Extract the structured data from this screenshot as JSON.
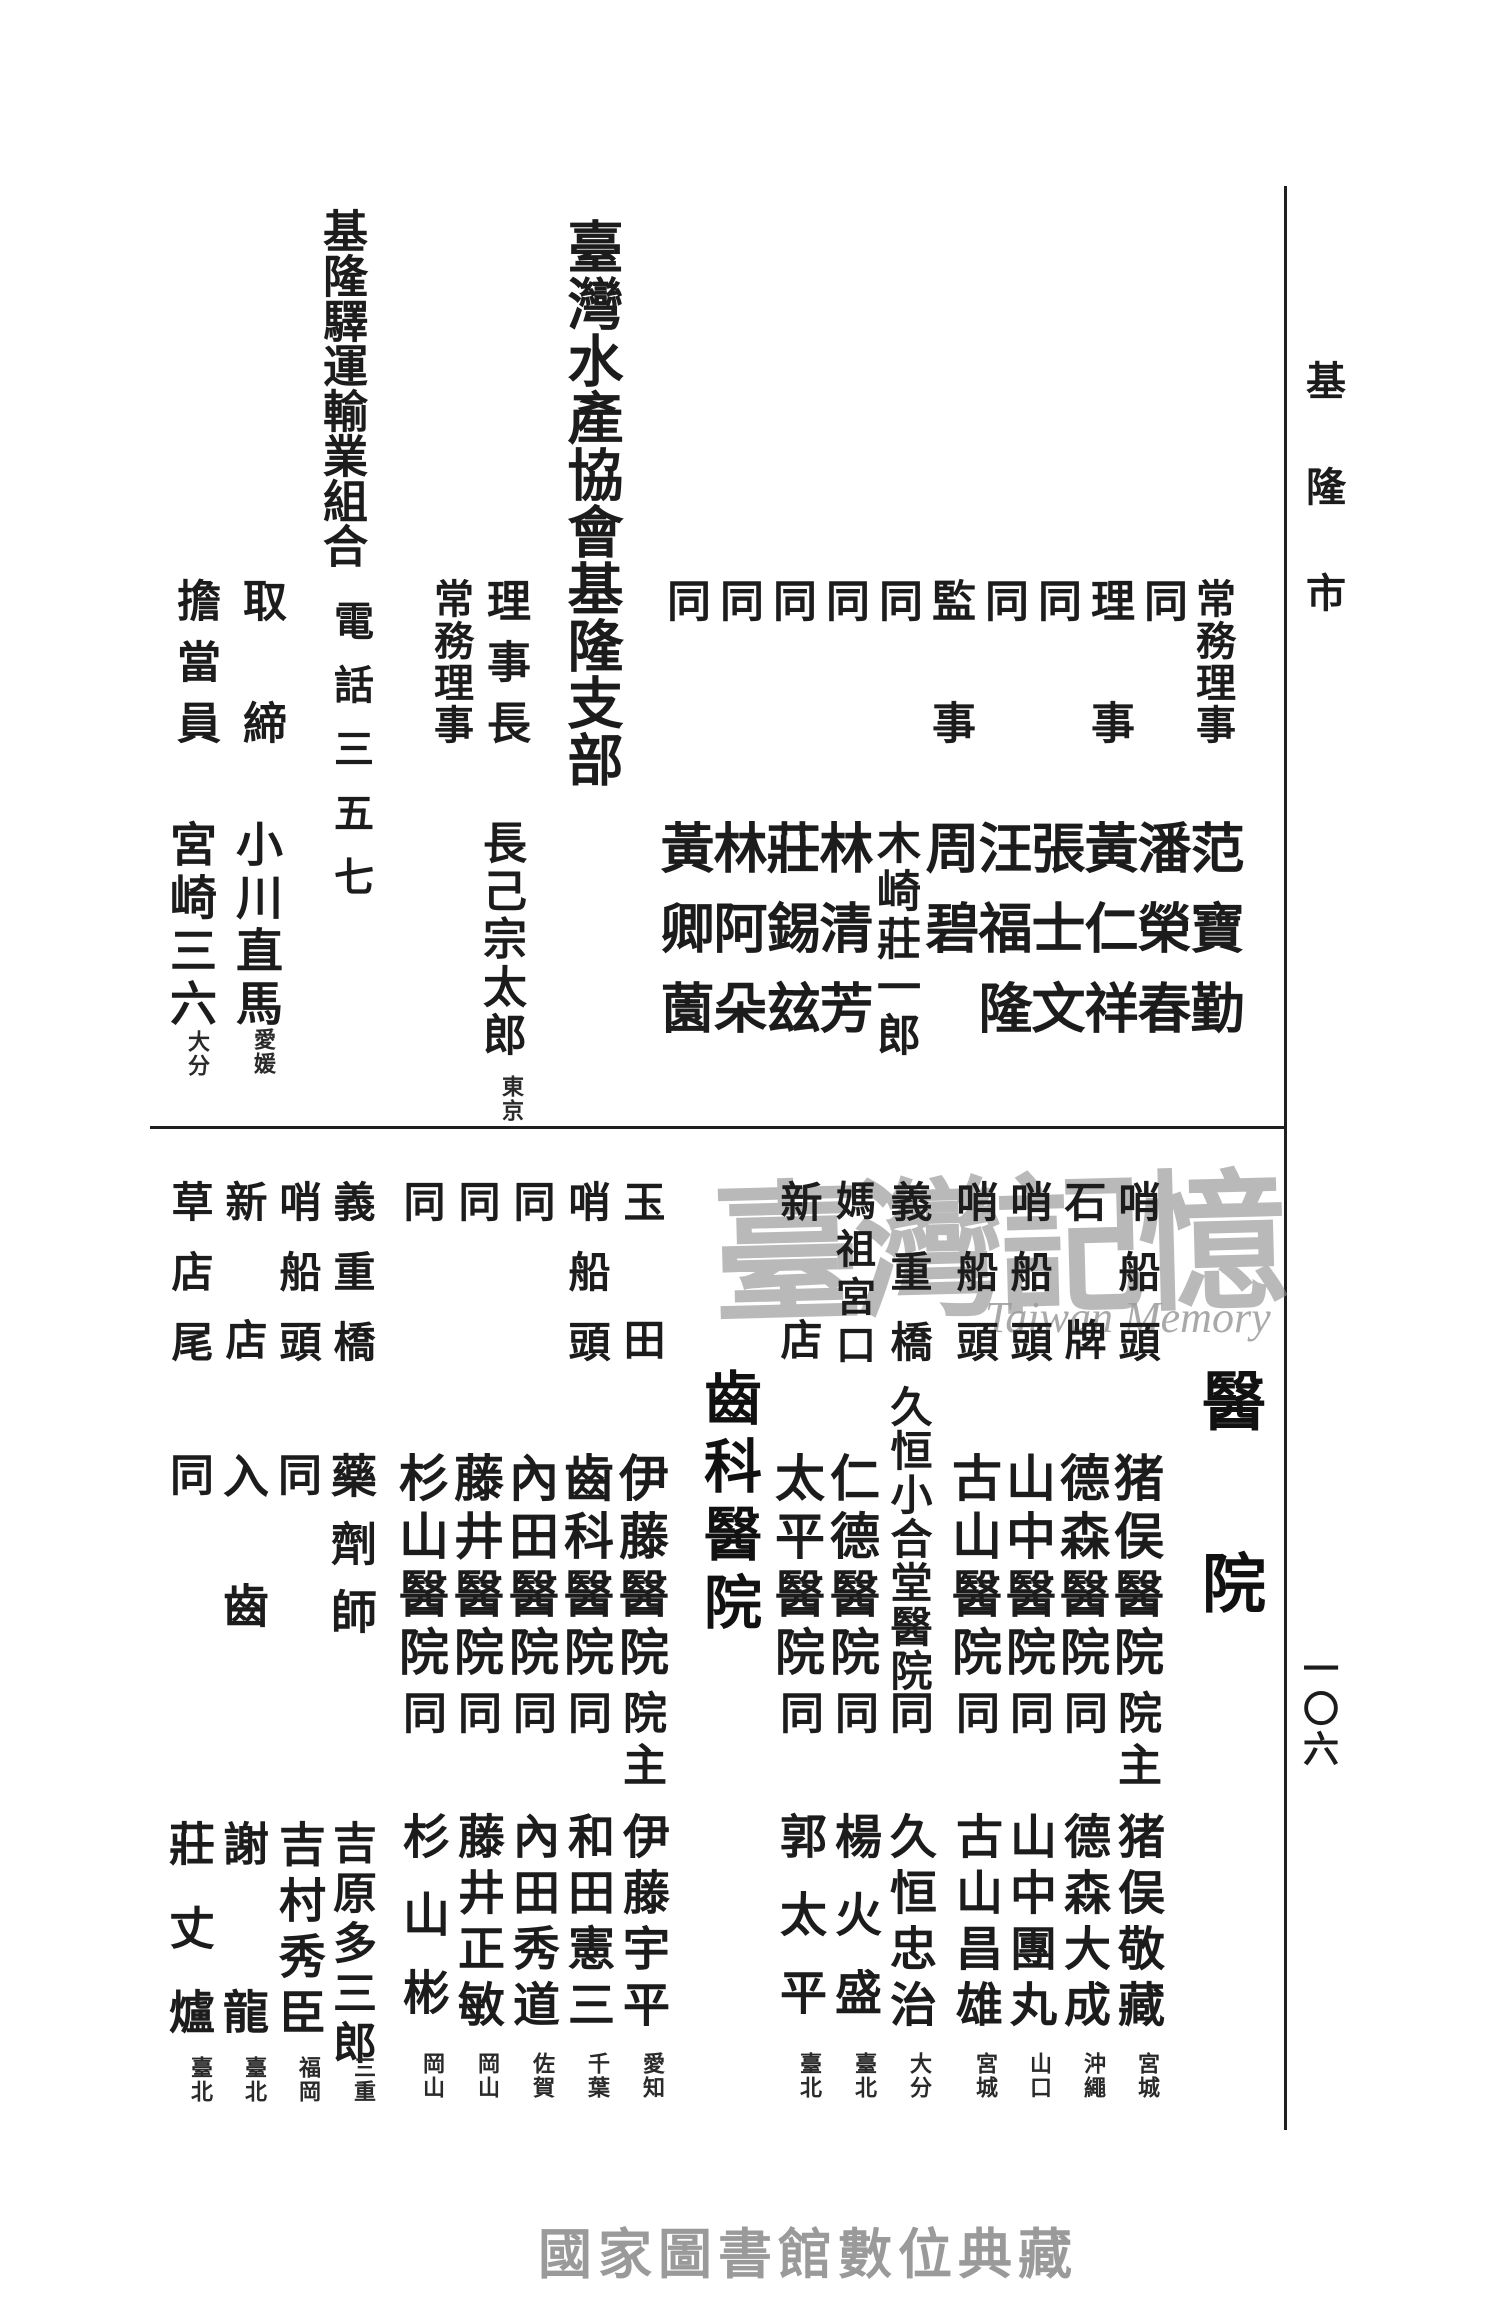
{
  "page": {
    "margin_label": "基隆市",
    "page_number": "一〇六",
    "footer": "國家圖書館數位典藏"
  },
  "watermark": {
    "text": "臺灣記憶",
    "subtext": "Taiwan Memory"
  },
  "top": {
    "officials": [
      {
        "role": "常務理事",
        "name": "范寶勤"
      },
      {
        "role": "同",
        "name": "潘榮春"
      },
      {
        "role": "理事",
        "name": "黃仁祥"
      },
      {
        "role": "同",
        "name": "張士文"
      },
      {
        "role": "同",
        "name": "汪福隆"
      },
      {
        "role": "監事",
        "name": "周碧"
      },
      {
        "role": "同",
        "name": "木崎莊一郎"
      },
      {
        "role": "同",
        "name": "林清芳"
      },
      {
        "role": "同",
        "name": "莊錫玆"
      },
      {
        "role": "同",
        "name": "林阿朵"
      },
      {
        "role": "同",
        "name": "黃卿薗"
      }
    ],
    "entry1": {
      "title": "臺灣水產協會基隆支部",
      "role1": "理事長",
      "name1": "長己宗太郎",
      "origin1": "東京",
      "role2": "常務理事"
    },
    "entry2": {
      "title": "基隆驛運輸業組合",
      "phone": "電話三五七",
      "role1": "取締",
      "name1": "小川直馬",
      "origin1": "愛媛",
      "role2": "擔當員",
      "name2": "宮崎三六",
      "origin2": "大分"
    }
  },
  "bottom": {
    "hospital_header": "醫院",
    "hospitals": [
      {
        "location": "哨船頭",
        "name": "猪俣醫院",
        "role": "院主",
        "person": "猪俣敬藏",
        "origin": "宮城"
      },
      {
        "location": "石牌",
        "name": "德森醫院",
        "role": "同",
        "person": "德森大成",
        "origin": "沖繩"
      },
      {
        "location": "哨船頭",
        "name": "山中醫院",
        "role": "同",
        "person": "山中團丸",
        "origin": "山口"
      },
      {
        "location": "哨船頭",
        "name": "古山醫院",
        "role": "同",
        "person": "古山昌雄",
        "origin": "宮城"
      },
      {
        "location": "義重橋",
        "name": "久恒小合堂醫院",
        "role": "同",
        "person": "久恒忠治",
        "origin": "大分"
      },
      {
        "location": "媽祖宮口",
        "name": "仁德醫院",
        "role": "同",
        "person": "楊火盛",
        "origin": "臺北"
      },
      {
        "location": "新店",
        "name": "太平醫院",
        "role": "同",
        "person": "郭太平",
        "origin": "臺北"
      }
    ],
    "dental_header": "齒科醫院",
    "dentists": [
      {
        "location": "玉田",
        "name": "伊藤醫院",
        "role": "院主",
        "person": "伊藤宇平",
        "origin": "愛知"
      },
      {
        "location": "哨船頭",
        "name": "齒科醫院",
        "role": "同",
        "person": "和田憲三",
        "origin": "千葉"
      },
      {
        "location": "同",
        "name": "內田醫院",
        "role": "同",
        "person": "內田秀道",
        "origin": "佐賀"
      },
      {
        "location": "同",
        "name": "藤井醫院",
        "role": "同",
        "person": "藤井正敏",
        "origin": "岡山"
      },
      {
        "location": "同",
        "name": "杉山醫院",
        "role": "同",
        "person": "杉山彬",
        "origin": "岡山"
      }
    ],
    "others": [
      {
        "location": "義重橋",
        "occupation": "藥劑師",
        "person": "吉原多三郎",
        "origin": "三重"
      },
      {
        "location": "哨船頭",
        "occupation": "同",
        "person": "吉村秀臣",
        "origin": "福岡"
      },
      {
        "location": "新店",
        "occupation": "入齒",
        "person": "謝龍",
        "origin": "臺北"
      },
      {
        "location": "草店尾",
        "occupation": "同",
        "person": "莊丈爐",
        "origin": "臺北"
      }
    ]
  }
}
